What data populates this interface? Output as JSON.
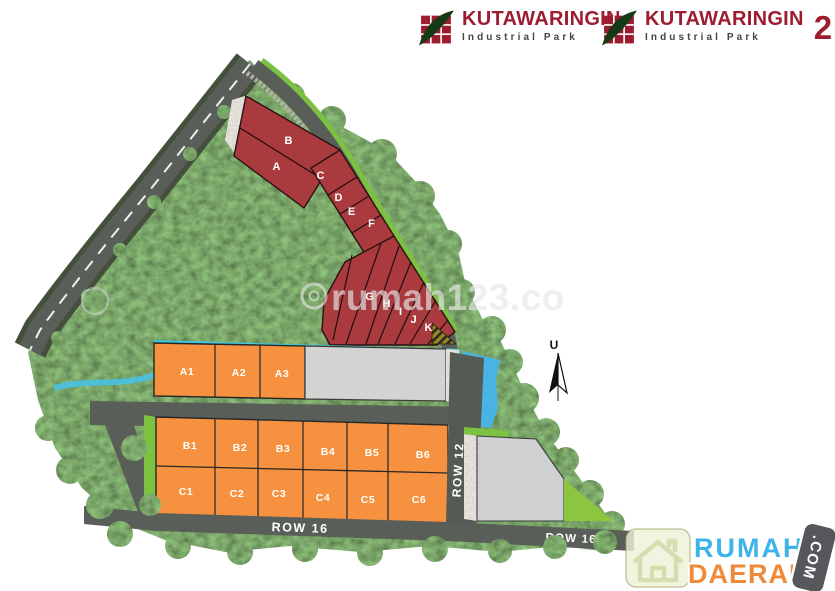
{
  "header": {
    "logo1": {
      "title": "KUTAWARINGIN",
      "subtitle": "Industrial Park"
    },
    "logo2": {
      "title": "KUTAWARINGIN",
      "subtitle": "Industrial Park",
      "number": "2"
    }
  },
  "siteplan": {
    "lots": {
      "red": [
        "A",
        "B",
        "C",
        "D",
        "E",
        "F",
        "G",
        "H",
        "I",
        "J",
        "K"
      ],
      "row_a": [
        "A1",
        "A2",
        "A3"
      ],
      "row_b": [
        "B1",
        "B2",
        "B3",
        "B4",
        "B5",
        "B6"
      ],
      "row_c": [
        "C1",
        "C2",
        "C3",
        "C4",
        "C5",
        "C6"
      ]
    },
    "roads": {
      "row12": "ROW 12",
      "row16_left": "ROW 16",
      "row16_right": "ROW 16"
    },
    "compass_north_label": "U"
  },
  "watermark": {
    "text": "rumah123.co"
  },
  "footer_logo": {
    "line1": "RUMAH",
    "line2": "DAERAH",
    "badge": ".COM"
  },
  "palette": {
    "red_lot": "#a93a3e",
    "orange_lot": "#f6923f",
    "gray_lot": "#d2d3d2",
    "road_gray": "#5a5e59",
    "tree_green": "#3d5531",
    "accent_green": "#7cc142",
    "water_blue": "#49b3e4",
    "cyan_strip": "#3fc8dc",
    "logo_red": "#9d1c30",
    "rumah_blue": "#3eb3e8",
    "daerah_orange": "#ef8a3b"
  }
}
